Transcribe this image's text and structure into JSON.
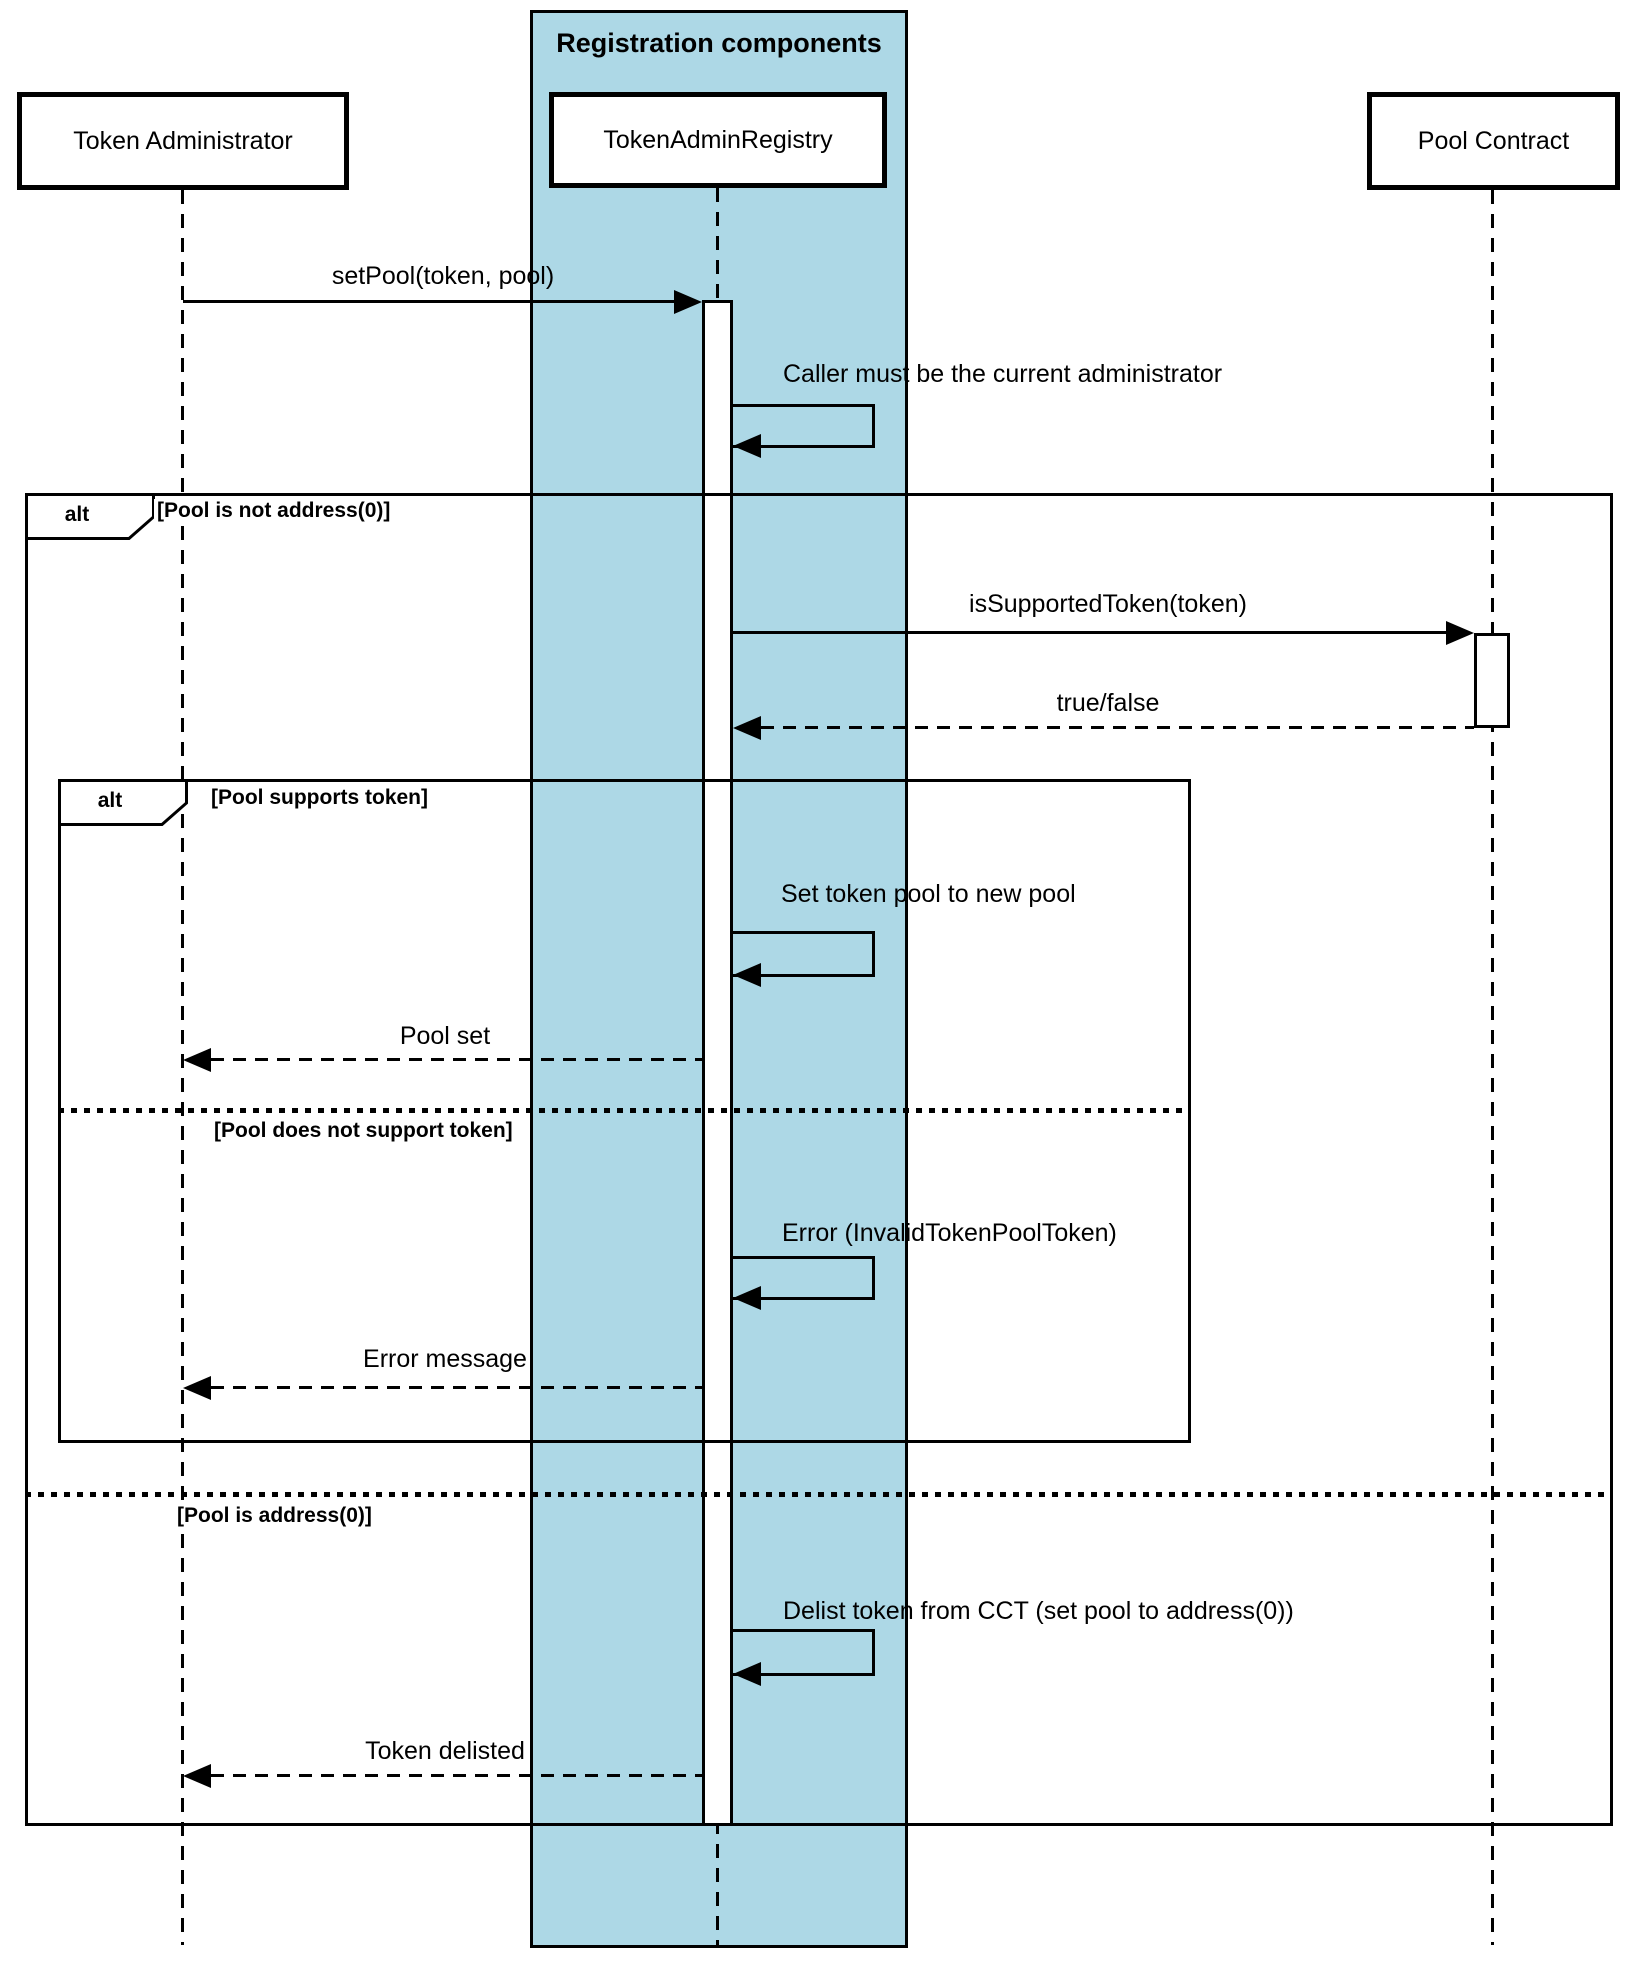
{
  "title": "Registration components",
  "actors": {
    "admin": "Token Administrator",
    "registry": "TokenAdminRegistry",
    "pool": "Pool Contract"
  },
  "alt_outer": {
    "keyword": "alt",
    "condition_true": "[Pool is not address(0)]",
    "condition_else": "[Pool is address(0)]"
  },
  "alt_inner": {
    "keyword": "alt",
    "condition_true": "[Pool supports token]",
    "condition_else": "[Pool does not support token]"
  },
  "messages": {
    "set_pool": "setPool(token, pool)",
    "caller_check": "Caller must be the current administrator",
    "is_supported_token": "isSupportedToken(token)",
    "true_false": "true/false",
    "set_token_pool": "Set token pool to new pool",
    "pool_set": "Pool set",
    "error_invalid_token": "Error (InvalidTokenPoolToken)",
    "error_message": "Error message",
    "delist_token": "Delist token from CCT (set pool to address(0))",
    "token_delisted": "Token delisted"
  },
  "colors": {
    "frame_fill": "#ADD8E6",
    "line": "#000000",
    "background": "#FFFFFF"
  }
}
